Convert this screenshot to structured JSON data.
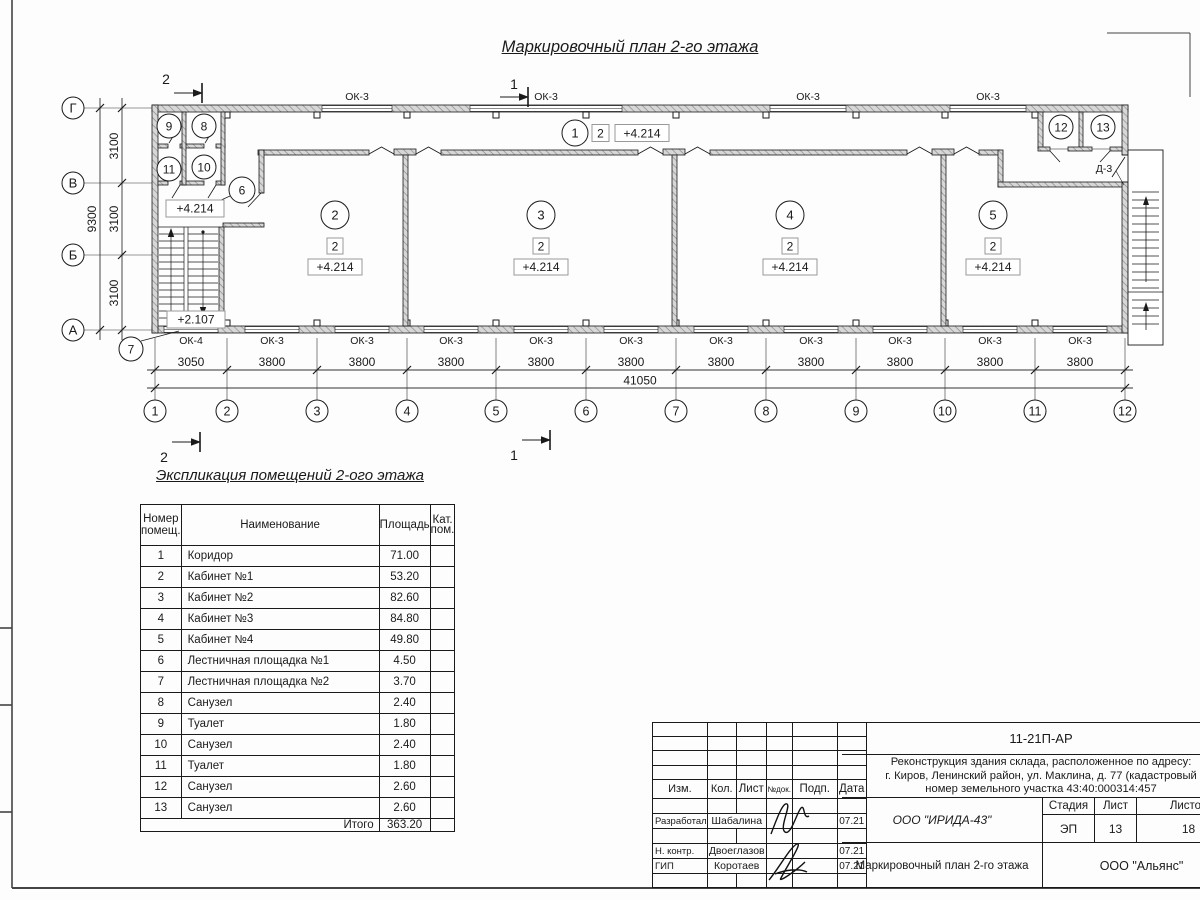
{
  "plan": {
    "title": "Маркировочный план 2-го этажа",
    "axes_bottom": [
      "1",
      "2",
      "3",
      "4",
      "5",
      "6",
      "7",
      "8",
      "9",
      "10",
      "11",
      "12"
    ],
    "axes_left": [
      "Г",
      "В",
      "Б",
      "А"
    ],
    "dims_bottom": [
      "3050",
      "3800",
      "3800",
      "3800",
      "3800",
      "3800",
      "3800",
      "3800",
      "3800",
      "3800",
      "3800"
    ],
    "dim_bottom_total": "41050",
    "dims_left": [
      "3100",
      "3100",
      "3100"
    ],
    "dim_left_total": "9300",
    "windows_top": [
      "ОК-3",
      "ОК-3",
      "ОК-3",
      "ОК-3"
    ],
    "windows_bottom": [
      "ОК-4",
      "ОК-3",
      "ОК-3",
      "ОК-3",
      "ОК-3",
      "ОК-3",
      "ОК-3",
      "ОК-3",
      "ОК-3",
      "ОК-3",
      "ОК-3"
    ],
    "door_label": "Д-3",
    "rooms_main": [
      {
        "num": "2",
        "floor": "2",
        "elev": "+4.214"
      },
      {
        "num": "3",
        "floor": "2",
        "elev": "+4.214"
      },
      {
        "num": "4",
        "floor": "2",
        "elev": "+4.214"
      },
      {
        "num": "5",
        "floor": "2",
        "elev": "+4.214"
      }
    ],
    "corridor": {
      "num": "1",
      "floor": "2",
      "elev": "+4.214"
    },
    "rooms_small": [
      "9",
      "8",
      "11",
      "10",
      "6",
      "7",
      "12",
      "13"
    ],
    "elev_landing": "+4.214",
    "elev_stair": "+2.107",
    "sections": {
      "s1": "1",
      "s2": "2"
    }
  },
  "schedule": {
    "title": "Экспликация помещений 2-ого этажа",
    "headers": {
      "num_l1": "Номер",
      "num_l2": "помещ.",
      "name": "Наименование",
      "area": "Площадь",
      "cat_l1": "Кат.",
      "cat_l2": "пом."
    },
    "rows": [
      [
        "1",
        "Коридор",
        "71.00",
        ""
      ],
      [
        "2",
        "Кабинет №1",
        "53.20",
        ""
      ],
      [
        "3",
        "Кабинет №2",
        "82.60",
        ""
      ],
      [
        "4",
        "Кабинет №3",
        "84.80",
        ""
      ],
      [
        "5",
        "Кабинет №4",
        "49.80",
        ""
      ],
      [
        "6",
        "Лестничная площадка №1",
        "4.50",
        ""
      ],
      [
        "7",
        "Лестничная площадка №2",
        "3.70",
        ""
      ],
      [
        "8",
        "Санузел",
        "2.40",
        ""
      ],
      [
        "9",
        "Туалет",
        "1.80",
        ""
      ],
      [
        "10",
        "Санузел",
        "2.40",
        ""
      ],
      [
        "11",
        "Туалет",
        "1.80",
        ""
      ],
      [
        "12",
        "Санузел",
        "2.60",
        ""
      ],
      [
        "13",
        "Санузел",
        "2.60",
        ""
      ]
    ],
    "total_label": "Итого",
    "total_value": "363.20"
  },
  "titleblock": {
    "doc_code": "11-21П-АР",
    "project_line1": "Реконструкция здания склада, расположенное по адресу:",
    "project_line2": "г. Киров, Ленинский район, ул. Маклина, д. 77 (кадастровый",
    "project_line3": "номер земельного участка 43:40:000314:457",
    "org1": "ООО \"ИРИДА-43\"",
    "org2": "ООО \"Альянс\"",
    "sheet_title": "Маркировочный план 2-го этажа",
    "cols": [
      "Изм.",
      "Кол.",
      "Лист",
      "№док.",
      "Подп.",
      "Дата"
    ],
    "rows": [
      {
        "role": "Разработал",
        "name": "Шабалина",
        "date": "07.21"
      },
      {
        "role": "Н. контр.",
        "name": "Двоеглазов",
        "date": "07.21"
      },
      {
        "role": "ГИП",
        "name": "Коротаев",
        "date": "07.21"
      }
    ],
    "stage_label": "Стадия",
    "sheet_label": "Лист",
    "sheets_label": "Листов",
    "stage": "ЭП",
    "sheet_no": "13",
    "sheets_total": "18"
  }
}
